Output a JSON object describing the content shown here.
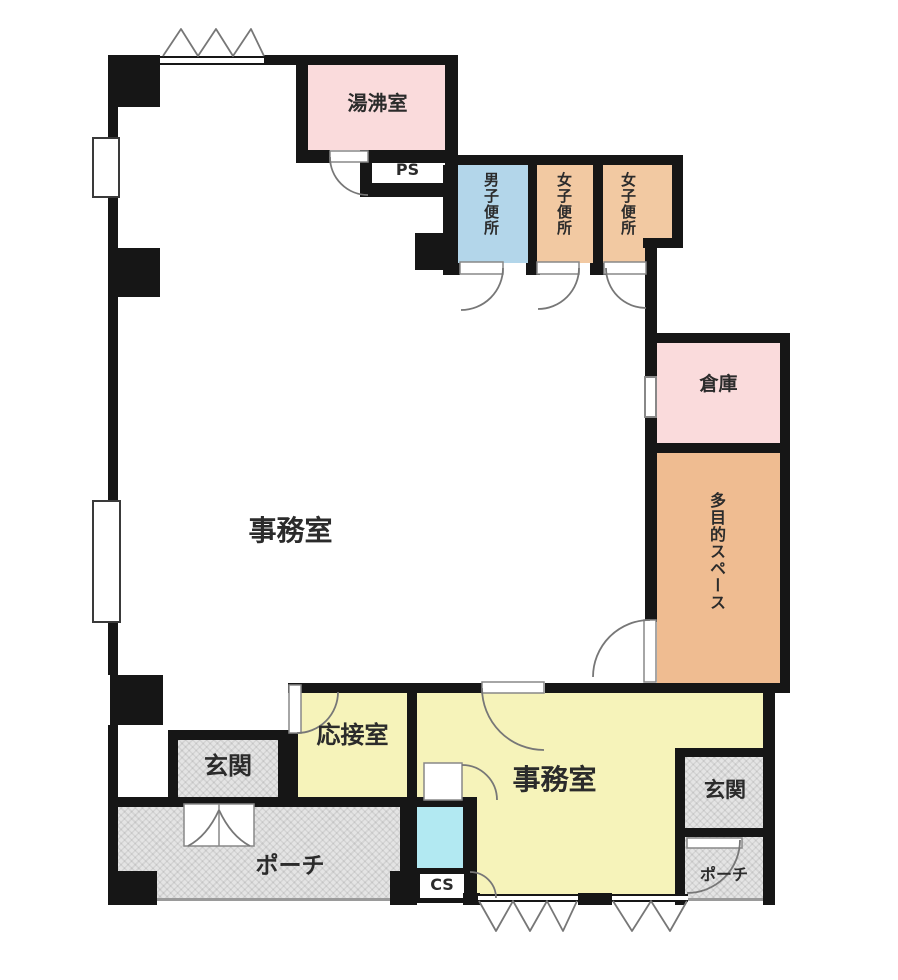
{
  "plan_title": "floor-plan",
  "rooms": {
    "yuwakashi": {
      "label": "湯沸室"
    },
    "ps": {
      "label": "PS"
    },
    "mens_wc": {
      "label": "男子便所"
    },
    "womens_wc_1": {
      "label": "女子便所"
    },
    "womens_wc_2": {
      "label": "女子便所"
    },
    "storage": {
      "label": "倉庫"
    },
    "multipurpose": {
      "label": "多目的スペース"
    },
    "office_main": {
      "label": "事務室"
    },
    "reception": {
      "label": "応接室"
    },
    "office_south": {
      "label": "事務室"
    },
    "entrance_west": {
      "label": "玄関"
    },
    "entrance_east": {
      "label": "玄関"
    },
    "porch_west": {
      "label": "ポーチ"
    },
    "porch_east": {
      "label": "ポーチ"
    },
    "cs": {
      "label": "CS"
    }
  },
  "colors": {
    "wall": "#161616",
    "pink": "#fadbdc",
    "blue": "#b3d6ea",
    "orange_light": "#f2c9a2",
    "orange": "#efbc91",
    "yellow": "#f6f3ba",
    "cyan": "#b2e9f2",
    "hatch_bg": "#e4e4e4"
  }
}
